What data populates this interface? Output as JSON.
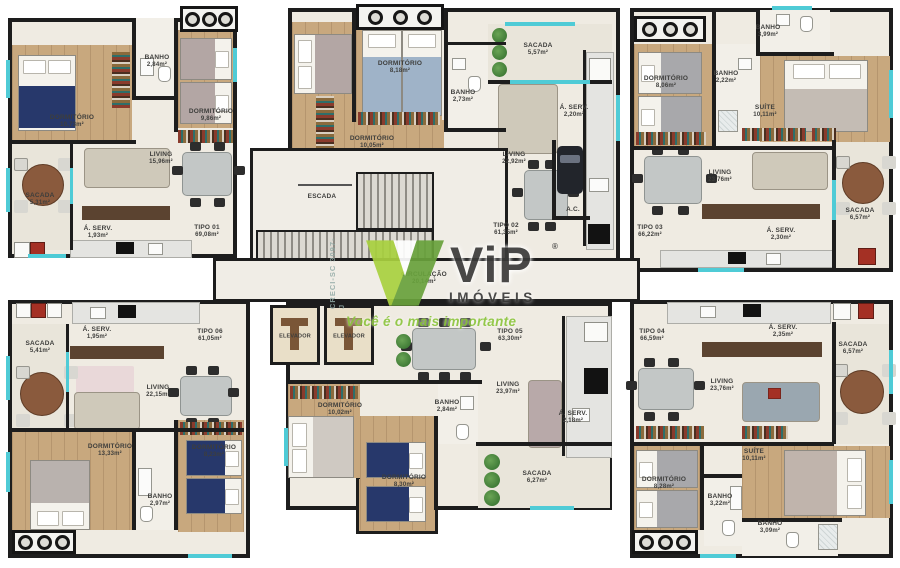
{
  "watermark": {
    "brand": "ViP",
    "reg": "®",
    "sub": "IMÓVEIS",
    "tagline": "Você é o mais importante",
    "creci": "CRECI-SC 3097-J",
    "green": "#8dc63f",
    "dark_text": "#3b3b3a"
  },
  "core": {
    "escada": "ESCADA",
    "ac": "A.C.",
    "circulacao": "CIRCULAÇÃO",
    "circulacao_area": "20,14m²",
    "elevador_left": "ELEVADOR",
    "elevador_right": "ELEVADOR"
  },
  "units": {
    "t1": {
      "tipo": "TIPO 01",
      "tipo_area": "69,08m²",
      "rooms": {
        "dorm1": {
          "name": "DORMITÓRIO",
          "area": "10,73m²"
        },
        "dorm2": {
          "name": "DORMITÓRIO",
          "area": "9,86m²"
        },
        "banho": {
          "name": "BANHO",
          "area": "2,84m²"
        },
        "living": {
          "name": "LIVING",
          "area": "15,96m²"
        },
        "sacada": {
          "name": "SACADA",
          "area": "5,31m²"
        },
        "aserv": {
          "name": "Á. SERV.",
          "area": "1,93m²"
        }
      }
    },
    "t2": {
      "tipo": "TIPO 02",
      "tipo_area": "61,35m²",
      "rooms": {
        "dorm1": {
          "name": "DORMITÓRIO",
          "area": "10,05m²"
        },
        "dorm2": {
          "name": "DORMITÓRIO",
          "area": "8,18m²"
        },
        "banho": {
          "name": "BANHO",
          "area": "2,73m²"
        },
        "living": {
          "name": "LIVING",
          "area": "22,92m²"
        },
        "sacada": {
          "name": "SACADA",
          "area": "5,57m²"
        },
        "aserv": {
          "name": "Á. SERV.",
          "area": "2,20m²"
        }
      }
    },
    "t3": {
      "tipo": "TIPO 03",
      "tipo_area": "66,22m²",
      "rooms": {
        "dorm": {
          "name": "DORMITÓRIO",
          "area": "8,06m²"
        },
        "banho1": {
          "name": "BANHO",
          "area": "2,22m²"
        },
        "banho2": {
          "name": "BANHO",
          "area": "3,99m²"
        },
        "suite": {
          "name": "SUÍTE",
          "area": "10,11m²"
        },
        "living": {
          "name": "LIVING",
          "area": "23,76m²"
        },
        "sacada": {
          "name": "SACADA",
          "area": "6,57m²"
        },
        "aserv": {
          "name": "Á. SERV.",
          "area": "2,30m²"
        }
      }
    },
    "t4": {
      "tipo": "TIPO 04",
      "tipo_area": "66,59m²",
      "rooms": {
        "dorm": {
          "name": "DORMITÓRIO",
          "area": "8,28m²"
        },
        "suite": {
          "name": "SUÍTE",
          "area": "10,11m²"
        },
        "banho1": {
          "name": "BANHO",
          "area": "3,22m²"
        },
        "banho2": {
          "name": "BANHO",
          "area": "3,09m²"
        },
        "living": {
          "name": "LIVING",
          "area": "23,76m²"
        },
        "sacada": {
          "name": "SACADA",
          "area": "6,57m²"
        },
        "aserv": {
          "name": "Á. SERV.",
          "area": "2,35m²"
        }
      }
    },
    "t5": {
      "tipo": "TIPO 05",
      "tipo_area": "63,30m²",
      "rooms": {
        "dorm1": {
          "name": "DORMITÓRIO",
          "area": "10,02m²"
        },
        "dorm2": {
          "name": "DORMITÓRIO",
          "area": "8,30m²"
        },
        "banho": {
          "name": "BANHO",
          "area": "2,84m²"
        },
        "living": {
          "name": "LIVING",
          "area": "23,97m²"
        },
        "sacada": {
          "name": "SACADA",
          "area": "6,27m²"
        },
        "aserv": {
          "name": "Á. SERV.",
          "area": "2,18m²"
        }
      }
    },
    "t6": {
      "tipo": "TIPO 06",
      "tipo_area": "61,05m²",
      "rooms": {
        "dorm1": {
          "name": "DORMITÓRIO",
          "area": "13,33m²"
        },
        "dorm2": {
          "name": "DORMITÓRIO",
          "area": "8,23m²"
        },
        "banho": {
          "name": "BANHO",
          "area": "2,97m²"
        },
        "living": {
          "name": "LIVING",
          "area": "22,15m²"
        },
        "sacada": {
          "name": "SACADA",
          "area": "5,41m²"
        },
        "aserv": {
          "name": "Á. SERV.",
          "area": "1,95m²"
        }
      }
    }
  }
}
